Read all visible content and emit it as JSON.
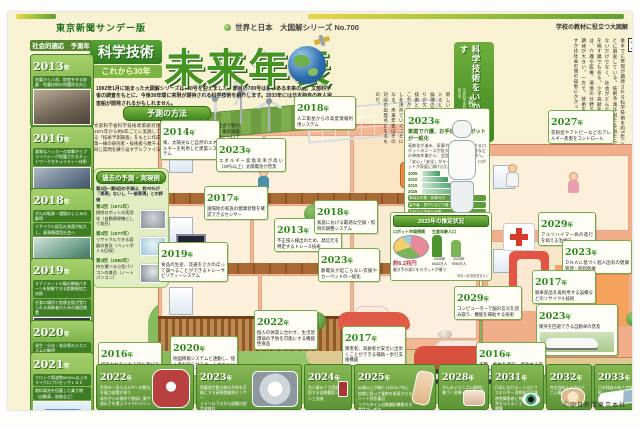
{
  "ui": {
    "year_suffix": "年"
  },
  "masthead": {
    "edition": "東京新聞サンデー版",
    "series": "世界と日本　大図解シリーズ",
    "series_no": "No.700",
    "school_note": "学校の教材に役立つ大図解",
    "copyright": "Ⓒ中日新聞東京本社"
  },
  "title": {
    "badge1": "科学技術",
    "badge2": "これから30年",
    "main": "未来年表",
    "intro": "1992年1月に始まった大図解シリーズは700号を迎えました。節目の700号は夢のある未来の話。文部科学省の調査をもとに、今後30年間に実現が期待される科学技術を紹介します。2033年には日本独自の有人宇宙船が開発されるかもしれません。"
  },
  "method": {
    "heading": "予測の方法",
    "body": "文部科学省科学技術政策研究所が1971年から約5年ごとに実施している「技術予測調査」をもとに作成。第一線の研究者・技術者ら数千人に同じ質問を繰り返すデルファイ法で意見を収束させ、技術が社会で使われる時期を予測している。最新調査では16分野・約1000課題について尋ねた。詳細は同研究所のホームページで。"
  },
  "past": {
    "heading": "過去の予測・実現例",
    "note": "第1回～第5回の予測は、約70％が「実現」ないし「一部実現」との評価",
    "items": [
      {
        "label": "第1回（1971年）",
        "text": "掃除ロボットの実用化（自動掃除機として発売）"
      },
      {
        "label": "第2回（1977年）",
        "text": "リサイクルできる容器の普及（ペットボトル回収）"
      },
      {
        "label": "第3回（1982年）",
        "text": "持ち運べる小型パソコンの普及（ノートパソコン）"
      }
    ]
  },
  "article": {
    "lead": "文",
    "headline1": "科学技術をいかす",
    "headline2": "社会の知恵が重要",
    "byline_org": "文部科学省科学技術政策研究所",
    "byline_name": "大竹　暁氏",
    "body": "部科学省科学技術政策研究所は、30年後までに実現が期待される科学技術を約5年ごとに調査している。技術予測は当たる当たらないだけでなく、社会がどんな未来を望むかを映す鏡でもある。少子高齢化が進む日本では、介護や医療、環境の分野で科学技術への期待が大きい。一方で、技術をどう使いこなすかは社会の側の知恵にかかっている。",
    "body2": "新しい技術が暮らしに入るときには、安全や倫理の面での合意づくりが欠かせない。科学技術と社会の対話が、これからの30年の暮らしを決めていくことになる。未来年表はその対話の出発点となるものだ。"
  },
  "left_column": {
    "heading": "社会的適応　予測年",
    "items": [
      {
        "year": "2013",
        "text": "地震から人命、財産を守る耐震・免震技術の飛躍的な向上",
        "text2": ""
      },
      {
        "year": "2016",
        "text": "悪質なハッカーの攻撃からプライバシーが保護されるネットワークセキュリティー技術",
        "text2": ""
      },
      {
        "year": "2018",
        "text": "がんの転移・増殖のしくみの解明",
        "text2": "リサイクル部品の流通が拡大し、資源循環型社会へ"
      },
      {
        "year": "2019",
        "text": "５ナノメートル幅の微細パターンを制御できる超微細加工技術",
        "text2": "任意の場所で医療支援が受けられる高齢者のための通信装置"
      },
      {
        "year": "2020",
        "text": "発生・分化・老化等のメカニズムの解明",
        "text2": ""
      },
      {
        "year": "2021",
        "text": "クロック周波数50GHz以上のマイクロプロセッサＬＳＩ",
        "text2": "燃料電池を搭載した乗り物（自動車、船舶など）"
      }
    ]
  },
  "callouts": [
    {
      "year": "2014",
      "text": "風、太陽光など自然のエネルギーを利用した建築システム"
    },
    {
      "year": "2023",
      "text": "エネルギー変換効率が高い（20％以上）太陽電池が普及"
    },
    {
      "year": "2018",
      "text": "人工衛星からの高度情報利用システム"
    },
    {
      "year": "2017",
      "text": "遠隔地の家族の健康状態を確認できるセンサー"
    },
    {
      "year": "2013",
      "text": "不正侵入検出のため、発信元を特定するトレース技術"
    },
    {
      "year": "2019",
      "text": "食品の生産、流通をさかのぼって調べることができるトレーサビリティーシステム"
    },
    {
      "year": "2022",
      "text": "個人の体質に合わせ、生活習慣病の予防を可能にする機能性食品"
    },
    {
      "year": "2020",
      "text": "地図情報システムと連動し、侵入者を知らせるホームセキュリティーシステム"
    },
    {
      "year": "2016",
      "text": "紙のかわりになる持ち運びできる電子ディスプレー"
    },
    {
      "year": "2018",
      "text": "家庭における最適な空調・照明の調整システム"
    },
    {
      "year": "2023",
      "text": "静電気が起こらない衣服やカーペットの一般化"
    },
    {
      "year": "2017",
      "text": "障害者、高齢者が安全に出歩くことができる補助・歩行支援機器"
    },
    {
      "year": "2029",
      "text": "コンピューターで脳の信号を読み取り、機能を補助する技術"
    },
    {
      "year": "2027",
      "text": "花粉症やアトピーなどのアレルギー疾患をコントロール"
    },
    {
      "year": "2029",
      "text": "アルツハイマー病の進行を抑える治療法"
    },
    {
      "year": "2023",
      "text": "ＤＮＡに基づく個人固有の健康管理・個別医療"
    },
    {
      "year": "2017",
      "text": "廃車部品を再利用する設備などのリサイクル技術"
    },
    {
      "year": "2023",
      "text": "衝突を回避できる自動車の普及"
    },
    {
      "year": "2016",
      "text": "盗難、事故を予知・予防する車載型センサーシステム"
    }
  ],
  "robot_panel": {
    "year": "2023",
    "headline": "家庭で介護、お手伝いのロボットが一般化",
    "body": "高齢化が進み、家事や介護を手助けするロボットのニーズが拡大。掃除や留守番などの単純作業から、会話など高度な作業へ。「安心」「安全」がキーワードとなり、ロボットが家庭に溶け込むと予測される。",
    "timeline": {
      "years": [
        "2005",
        "2010",
        "2015",
        "2025"
      ],
      "chips": [
        "単純な作業・家事代行",
        "留守番・見守りなど介護・補助",
        "会話など高度な作業"
      ]
    },
    "estimate": {
      "heading": "2025年の推定状況",
      "market_title": "ロボット市場規模",
      "market_total": "約6.2兆円",
      "pop_title": "生産年齢人口",
      "pop": [
        {
          "year": "2005年",
          "value": "8442万人"
        },
        {
          "year": "2025年",
          "value": "7096万人"
        }
      ],
      "note": "働き手の減少をロボットが補う",
      "source": "資料＝経済産業省など"
    }
  },
  "bottom_row": [
    {
      "year": "2022",
      "l1": "世界の一次エネルギーの数％を風力発電が担う",
      "l2": "体外からの操作で患部に薬や遺伝子を運ぶマイクロマシン"
    },
    {
      "year": "2023",
      "l1": "地震発生数分前の予知を可能にする高密度観測センサー",
      "l2": "１ミリ以下のがん組織の超音波検診"
    },
    {
      "year": "2024",
      "l1": "名人級の７カ国語を翻訳する自動翻訳ソフト",
      "l2": "人工血液"
    },
    {
      "year": "2025",
      "l1": "65歳以上が総人口の28.7％に",
      "l2": "皮膚に貼って薬剤を吸収させるシート状医薬品",
      "l3": "リアルタイム自動翻訳機能付き電話が一般化"
    },
    {
      "year": "2028",
      "l1": "がんのメカニズム解明に基づく治療への応用"
    },
    {
      "year": "2031",
      "l1": "日本における一人当たりエネルギー消費量が半減",
      "l2": "視覚障害者に視覚を与える人工網膜"
    },
    {
      "year": "2032",
      "l1": "完全埋め込み型の人工心臓"
    },
    {
      "year": "2033",
      "l1": "日本独自の有人宇宙船"
    }
  ]
}
